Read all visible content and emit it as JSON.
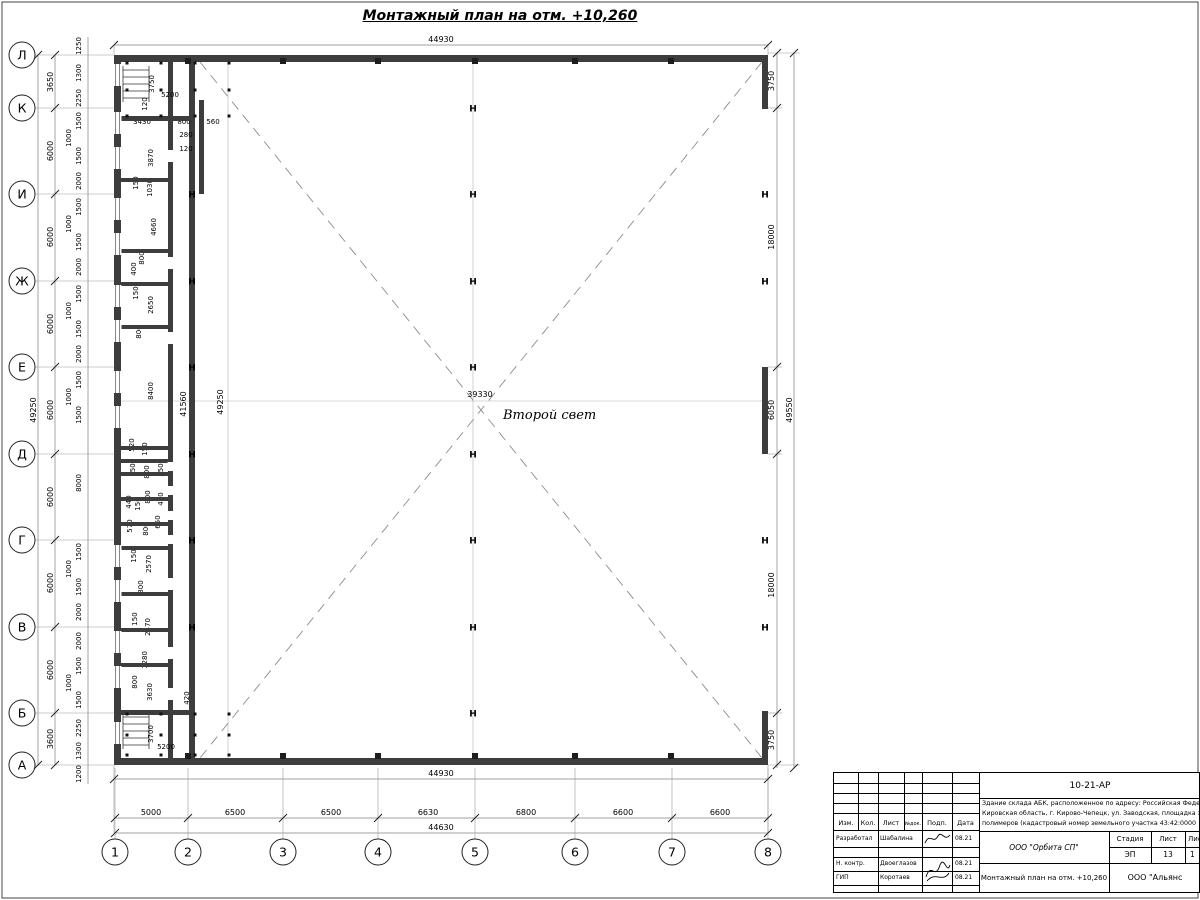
{
  "title": "Монтажный план на отм. +10,260",
  "center": {
    "void_label": "Второй свет"
  },
  "axes": {
    "left": [
      {
        "label": "Л",
        "y": 55
      },
      {
        "label": "К",
        "y": 108
      },
      {
        "label": "И",
        "y": 194
      },
      {
        "label": "Ж",
        "y": 281
      },
      {
        "label": "Е",
        "y": 367
      },
      {
        "label": "Д",
        "y": 454
      },
      {
        "label": "Г",
        "y": 540
      },
      {
        "label": "В",
        "y": 627
      },
      {
        "label": "Б",
        "y": 713
      },
      {
        "label": "А",
        "y": 765
      }
    ],
    "bottom": [
      {
        "label": "1",
        "x": 115
      },
      {
        "label": "2",
        "x": 188
      },
      {
        "label": "3",
        "x": 283
      },
      {
        "label": "4",
        "x": 378
      },
      {
        "label": "5",
        "x": 475
      },
      {
        "label": "6",
        "x": 575
      },
      {
        "label": "7",
        "x": 672
      },
      {
        "label": "8",
        "x": 768
      }
    ]
  },
  "dim_labels": [
    {
      "t": "44930",
      "x": 441,
      "y": 42
    },
    {
      "t": "44930",
      "x": 441,
      "y": 776
    },
    {
      "t": "5000",
      "x": 151,
      "y": 815
    },
    {
      "t": "6500",
      "x": 235,
      "y": 815
    },
    {
      "t": "6500",
      "x": 331,
      "y": 815
    },
    {
      "t": "6630",
      "x": 428,
      "y": 815
    },
    {
      "t": "6800",
      "x": 526,
      "y": 815
    },
    {
      "t": "6600",
      "x": 623,
      "y": 815
    },
    {
      "t": "6600",
      "x": 720,
      "y": 815
    },
    {
      "t": "44630",
      "x": 441,
      "y": 830
    },
    {
      "t": "49250",
      "x": 36,
      "y": 410,
      "r": 1
    },
    {
      "t": "3650",
      "x": 53,
      "y": 82,
      "r": 1
    },
    {
      "t": "6000",
      "x": 53,
      "y": 151,
      "r": 1
    },
    {
      "t": "6000",
      "x": 53,
      "y": 237,
      "r": 1
    },
    {
      "t": "6000",
      "x": 53,
      "y": 324,
      "r": 1
    },
    {
      "t": "6000",
      "x": 53,
      "y": 410,
      "r": 1
    },
    {
      "t": "6000",
      "x": 53,
      "y": 497,
      "r": 1
    },
    {
      "t": "6000",
      "x": 53,
      "y": 583,
      "r": 1
    },
    {
      "t": "6000",
      "x": 53,
      "y": 670,
      "r": 1
    },
    {
      "t": "3600",
      "x": 53,
      "y": 739,
      "r": 1
    },
    {
      "t": "1250",
      "x": 81,
      "y": 46,
      "r": 1,
      "s": 1
    },
    {
      "t": "1200",
      "x": 81,
      "y": 774,
      "r": 1,
      "s": 1
    },
    {
      "t": "1300",
      "x": 81,
      "y": 73,
      "r": 1,
      "s": 1
    },
    {
      "t": "2250",
      "x": 81,
      "y": 98,
      "r": 1,
      "s": 1
    },
    {
      "t": "1500",
      "x": 81,
      "y": 121,
      "r": 1,
      "s": 1
    },
    {
      "t": "1000",
      "x": 71,
      "y": 138,
      "r": 1,
      "s": 1
    },
    {
      "t": "1500",
      "x": 81,
      "y": 156,
      "r": 1,
      "s": 1
    },
    {
      "t": "2000",
      "x": 81,
      "y": 181,
      "r": 1,
      "s": 1
    },
    {
      "t": "1500",
      "x": 81,
      "y": 207,
      "r": 1,
      "s": 1
    },
    {
      "t": "1000",
      "x": 71,
      "y": 224,
      "r": 1,
      "s": 1
    },
    {
      "t": "1500",
      "x": 81,
      "y": 242,
      "r": 1,
      "s": 1
    },
    {
      "t": "2000",
      "x": 81,
      "y": 267,
      "r": 1,
      "s": 1
    },
    {
      "t": "1500",
      "x": 81,
      "y": 294,
      "r": 1,
      "s": 1
    },
    {
      "t": "1000",
      "x": 71,
      "y": 311,
      "r": 1,
      "s": 1
    },
    {
      "t": "1500",
      "x": 81,
      "y": 329,
      "r": 1,
      "s": 1
    },
    {
      "t": "2000",
      "x": 81,
      "y": 354,
      "r": 1,
      "s": 1
    },
    {
      "t": "1500",
      "x": 81,
      "y": 380,
      "r": 1,
      "s": 1
    },
    {
      "t": "1000",
      "x": 71,
      "y": 397,
      "r": 1,
      "s": 1
    },
    {
      "t": "1500",
      "x": 81,
      "y": 415,
      "r": 1,
      "s": 1
    },
    {
      "t": "8000",
      "x": 81,
      "y": 483,
      "r": 1,
      "s": 1
    },
    {
      "t": "1500",
      "x": 81,
      "y": 552,
      "r": 1,
      "s": 1
    },
    {
      "t": "1000",
      "x": 71,
      "y": 569,
      "r": 1,
      "s": 1
    },
    {
      "t": "1500",
      "x": 81,
      "y": 587,
      "r": 1,
      "s": 1
    },
    {
      "t": "2000",
      "x": 81,
      "y": 612,
      "r": 1,
      "s": 1
    },
    {
      "t": "2000",
      "x": 81,
      "y": 641,
      "r": 1,
      "s": 1
    },
    {
      "t": "1500",
      "x": 81,
      "y": 666,
      "r": 1,
      "s": 1
    },
    {
      "t": "1000",
      "x": 71,
      "y": 683,
      "r": 1,
      "s": 1
    },
    {
      "t": "1500",
      "x": 81,
      "y": 700,
      "r": 1,
      "s": 1
    },
    {
      "t": "2250",
      "x": 81,
      "y": 728,
      "r": 1,
      "s": 1
    },
    {
      "t": "1300",
      "x": 81,
      "y": 751,
      "r": 1,
      "s": 1
    },
    {
      "t": "3750",
      "x": 774,
      "y": 81,
      "r": 1
    },
    {
      "t": "18000",
      "x": 774,
      "y": 237,
      "r": 1
    },
    {
      "t": "6050",
      "x": 774,
      "y": 410,
      "r": 1
    },
    {
      "t": "18000",
      "x": 774,
      "y": 585,
      "r": 1
    },
    {
      "t": "3750",
      "x": 774,
      "y": 740,
      "r": 1
    },
    {
      "t": "49550",
      "x": 792,
      "y": 410,
      "r": 1
    },
    {
      "t": "39330",
      "x": 480,
      "y": 397
    },
    {
      "t": "41560",
      "x": 186,
      "y": 404,
      "r": 1
    },
    {
      "t": "49250",
      "x": 223,
      "y": 402,
      "r": 1
    },
    {
      "t": "3750",
      "x": 154,
      "y": 84,
      "r": 1,
      "s": 1
    },
    {
      "t": "5200",
      "x": 170,
      "y": 97,
      "s": 1
    },
    {
      "t": "120",
      "x": 147,
      "y": 104,
      "r": 1,
      "s": 1
    },
    {
      "t": "3430",
      "x": 142,
      "y": 124,
      "s": 1
    },
    {
      "t": "800",
      "x": 184,
      "y": 124,
      "s": 1
    },
    {
      "t": "560",
      "x": 213,
      "y": 124,
      "s": 1
    },
    {
      "t": "280",
      "x": 186,
      "y": 137,
      "s": 1
    },
    {
      "t": "120",
      "x": 186,
      "y": 151,
      "s": 1
    },
    {
      "t": "3870",
      "x": 153,
      "y": 158,
      "r": 1,
      "s": 1
    },
    {
      "t": "150",
      "x": 138,
      "y": 183,
      "r": 1,
      "s": 1
    },
    {
      "t": "1030",
      "x": 152,
      "y": 188,
      "r": 1,
      "s": 1
    },
    {
      "t": "4660",
      "x": 156,
      "y": 227,
      "r": 1,
      "s": 1
    },
    {
      "t": "800",
      "x": 144,
      "y": 258,
      "r": 1,
      "s": 1
    },
    {
      "t": "400",
      "x": 136,
      "y": 269,
      "r": 1,
      "s": 1
    },
    {
      "t": "150",
      "x": 138,
      "y": 293,
      "r": 1,
      "s": 1
    },
    {
      "t": "2650",
      "x": 153,
      "y": 305,
      "r": 1,
      "s": 1
    },
    {
      "t": "800",
      "x": 141,
      "y": 332,
      "r": 1,
      "s": 1
    },
    {
      "t": "8400",
      "x": 153,
      "y": 391,
      "r": 1,
      "s": 1
    },
    {
      "t": "520",
      "x": 134,
      "y": 445,
      "r": 1,
      "s": 1
    },
    {
      "t": "150",
      "x": 147,
      "y": 449,
      "r": 1,
      "s": 1
    },
    {
      "t": "150",
      "x": 135,
      "y": 470,
      "r": 1,
      "s": 1
    },
    {
      "t": "800",
      "x": 149,
      "y": 472,
      "r": 1,
      "s": 1
    },
    {
      "t": "550",
      "x": 163,
      "y": 470,
      "r": 1,
      "s": 1
    },
    {
      "t": "440",
      "x": 131,
      "y": 502,
      "r": 1,
      "s": 1
    },
    {
      "t": "150",
      "x": 140,
      "y": 504,
      "r": 1,
      "s": 1
    },
    {
      "t": "800",
      "x": 150,
      "y": 497,
      "r": 1,
      "s": 1
    },
    {
      "t": "420",
      "x": 163,
      "y": 499,
      "r": 1,
      "s": 1
    },
    {
      "t": "570",
      "x": 132,
      "y": 526,
      "r": 1,
      "s": 1
    },
    {
      "t": "800",
      "x": 148,
      "y": 529,
      "r": 1,
      "s": 1
    },
    {
      "t": "650",
      "x": 160,
      "y": 522,
      "r": 1,
      "s": 1
    },
    {
      "t": "150",
      "x": 136,
      "y": 556,
      "r": 1,
      "s": 1
    },
    {
      "t": "2570",
      "x": 151,
      "y": 564,
      "r": 1,
      "s": 1
    },
    {
      "t": "800",
      "x": 143,
      "y": 587,
      "r": 1,
      "s": 1
    },
    {
      "t": "150",
      "x": 137,
      "y": 619,
      "r": 1,
      "s": 1
    },
    {
      "t": "2470",
      "x": 150,
      "y": 627,
      "r": 1,
      "s": 1
    },
    {
      "t": "1280",
      "x": 147,
      "y": 660,
      "r": 1,
      "s": 1
    },
    {
      "t": "800",
      "x": 137,
      "y": 682,
      "r": 1,
      "s": 1
    },
    {
      "t": "3630",
      "x": 152,
      "y": 692,
      "r": 1,
      "s": 1
    },
    {
      "t": "420",
      "x": 189,
      "y": 698,
      "r": 1,
      "s": 1
    },
    {
      "t": "3700",
      "x": 153,
      "y": 734,
      "r": 1,
      "s": 1
    },
    {
      "t": "5200",
      "x": 166,
      "y": 749,
      "s": 1
    }
  ],
  "plan": {
    "partitions_small": [
      178,
      249,
      282,
      325,
      446,
      459,
      472,
      497,
      522,
      546,
      592,
      628,
      663
    ],
    "partitions_full": [
      116,
      710
    ],
    "windows": [
      64,
      112,
      147,
      198,
      233,
      285,
      320,
      371,
      406,
      545,
      580,
      631,
      666,
      722
    ],
    "doors": [
      {
        "y": 150,
        "h": 12
      },
      {
        "y": 257,
        "h": 12
      },
      {
        "y": 332,
        "h": 12
      },
      {
        "y": 462,
        "h": 9
      },
      {
        "y": 486,
        "h": 9
      },
      {
        "y": 511,
        "h": 9
      },
      {
        "y": 535,
        "h": 9
      },
      {
        "y": 578,
        "h": 12
      },
      {
        "y": 647,
        "h": 12
      },
      {
        "y": 688,
        "h": 12
      }
    ],
    "h_columns": [
      {
        "x": 192,
        "y": 194
      },
      {
        "x": 192,
        "y": 281
      },
      {
        "x": 192,
        "y": 367
      },
      {
        "x": 192,
        "y": 454
      },
      {
        "x": 192,
        "y": 540
      },
      {
        "x": 192,
        "y": 627
      },
      {
        "x": 473,
        "y": 108
      },
      {
        "x": 473,
        "y": 194
      },
      {
        "x": 473,
        "y": 281
      },
      {
        "x": 473,
        "y": 367
      },
      {
        "x": 473,
        "y": 454
      },
      {
        "x": 473,
        "y": 540
      },
      {
        "x": 473,
        "y": 627
      },
      {
        "x": 473,
        "y": 713
      },
      {
        "x": 765,
        "y": 194
      },
      {
        "x": 765,
        "y": 281
      },
      {
        "x": 765,
        "y": 540
      },
      {
        "x": 765,
        "y": 627
      }
    ],
    "sq_columns": [
      {
        "x": 188,
        "y": 58
      },
      {
        "x": 283,
        "y": 58
      },
      {
        "x": 378,
        "y": 58
      },
      {
        "x": 475,
        "y": 58
      },
      {
        "x": 575,
        "y": 58
      },
      {
        "x": 671,
        "y": 58
      },
      {
        "x": 188,
        "y": 753
      },
      {
        "x": 283,
        "y": 753
      },
      {
        "x": 378,
        "y": 753
      },
      {
        "x": 475,
        "y": 753
      },
      {
        "x": 575,
        "y": 753
      },
      {
        "x": 671,
        "y": 753
      }
    ],
    "dots": [
      {
        "x": 127,
        "y": 63
      },
      {
        "x": 161,
        "y": 63
      },
      {
        "x": 195,
        "y": 63
      },
      {
        "x": 229,
        "y": 63
      },
      {
        "x": 127,
        "y": 90
      },
      {
        "x": 161,
        "y": 90
      },
      {
        "x": 195,
        "y": 90
      },
      {
        "x": 229,
        "y": 90
      },
      {
        "x": 127,
        "y": 116
      },
      {
        "x": 161,
        "y": 116
      },
      {
        "x": 195,
        "y": 116
      },
      {
        "x": 229,
        "y": 116
      },
      {
        "x": 127,
        "y": 714
      },
      {
        "x": 161,
        "y": 714
      },
      {
        "x": 195,
        "y": 714
      },
      {
        "x": 229,
        "y": 714
      },
      {
        "x": 127,
        "y": 735
      },
      {
        "x": 161,
        "y": 735
      },
      {
        "x": 195,
        "y": 735
      },
      {
        "x": 229,
        "y": 735
      },
      {
        "x": 127,
        "y": 755
      },
      {
        "x": 161,
        "y": 755
      },
      {
        "x": 195,
        "y": 755
      },
      {
        "x": 229,
        "y": 755
      }
    ],
    "ticks": [
      {
        "x": 115,
        "y": 818
      },
      {
        "x": 188,
        "y": 818
      },
      {
        "x": 283,
        "y": 818
      },
      {
        "x": 378,
        "y": 818
      },
      {
        "x": 475,
        "y": 818
      },
      {
        "x": 575,
        "y": 818
      },
      {
        "x": 672,
        "y": 818
      },
      {
        "x": 768,
        "y": 818
      },
      {
        "x": 115,
        "y": 833
      },
      {
        "x": 768,
        "y": 833
      },
      {
        "x": 114,
        "y": 779
      },
      {
        "x": 768,
        "y": 779
      },
      {
        "x": 114,
        "y": 45
      },
      {
        "x": 768,
        "y": 45
      },
      {
        "x": 55,
        "y": 55
      },
      {
        "x": 55,
        "y": 108
      },
      {
        "x": 55,
        "y": 194
      },
      {
        "x": 55,
        "y": 281
      },
      {
        "x": 55,
        "y": 367
      },
      {
        "x": 55,
        "y": 454
      },
      {
        "x": 55,
        "y": 540
      },
      {
        "x": 55,
        "y": 627
      },
      {
        "x": 55,
        "y": 713
      },
      {
        "x": 55,
        "y": 765
      },
      {
        "x": 38,
        "y": 55
      },
      {
        "x": 38,
        "y": 765
      },
      {
        "x": 777,
        "y": 53
      },
      {
        "x": 777,
        "y": 108
      },
      {
        "x": 777,
        "y": 367
      },
      {
        "x": 777,
        "y": 454
      },
      {
        "x": 777,
        "y": 713
      },
      {
        "x": 777,
        "y": 765
      },
      {
        "x": 794,
        "y": 53
      },
      {
        "x": 794,
        "y": 768
      }
    ]
  },
  "title_block": {
    "doc_number": "10-21-АР",
    "desc_lines": [
      "Здание склада АБК, расположенное по адресу: Российская Феде",
      "Кировская область, г. Кирово-Чепецк, ул. Заводская, площадка з",
      "полимеров (кадастровый номер земельного участка 43:42:0000"
    ],
    "header_cols": [
      "Изм.",
      "Кол.",
      "Лист",
      "№док.",
      "Подп.",
      "Дата"
    ],
    "rows": [
      {
        "role": "Разработал",
        "name": "Шабалина",
        "date": "08.21"
      },
      {
        "role": "Н. контр.",
        "name": "Двоеглазов",
        "date": "08.21"
      },
      {
        "role": "ГИП",
        "name": "Коротаев",
        "date": "08.21"
      }
    ],
    "stage_label": "Стадия",
    "sheet_label": "Лист",
    "sheets_label": "Листов",
    "stage": "ЭП",
    "sheet": "13",
    "sheets": "1",
    "org1": "ООО \"Орбита СП\"",
    "drawing_title": "Монтажный план на отм. +10,260",
    "org2": "ООО \"Альянс"
  }
}
